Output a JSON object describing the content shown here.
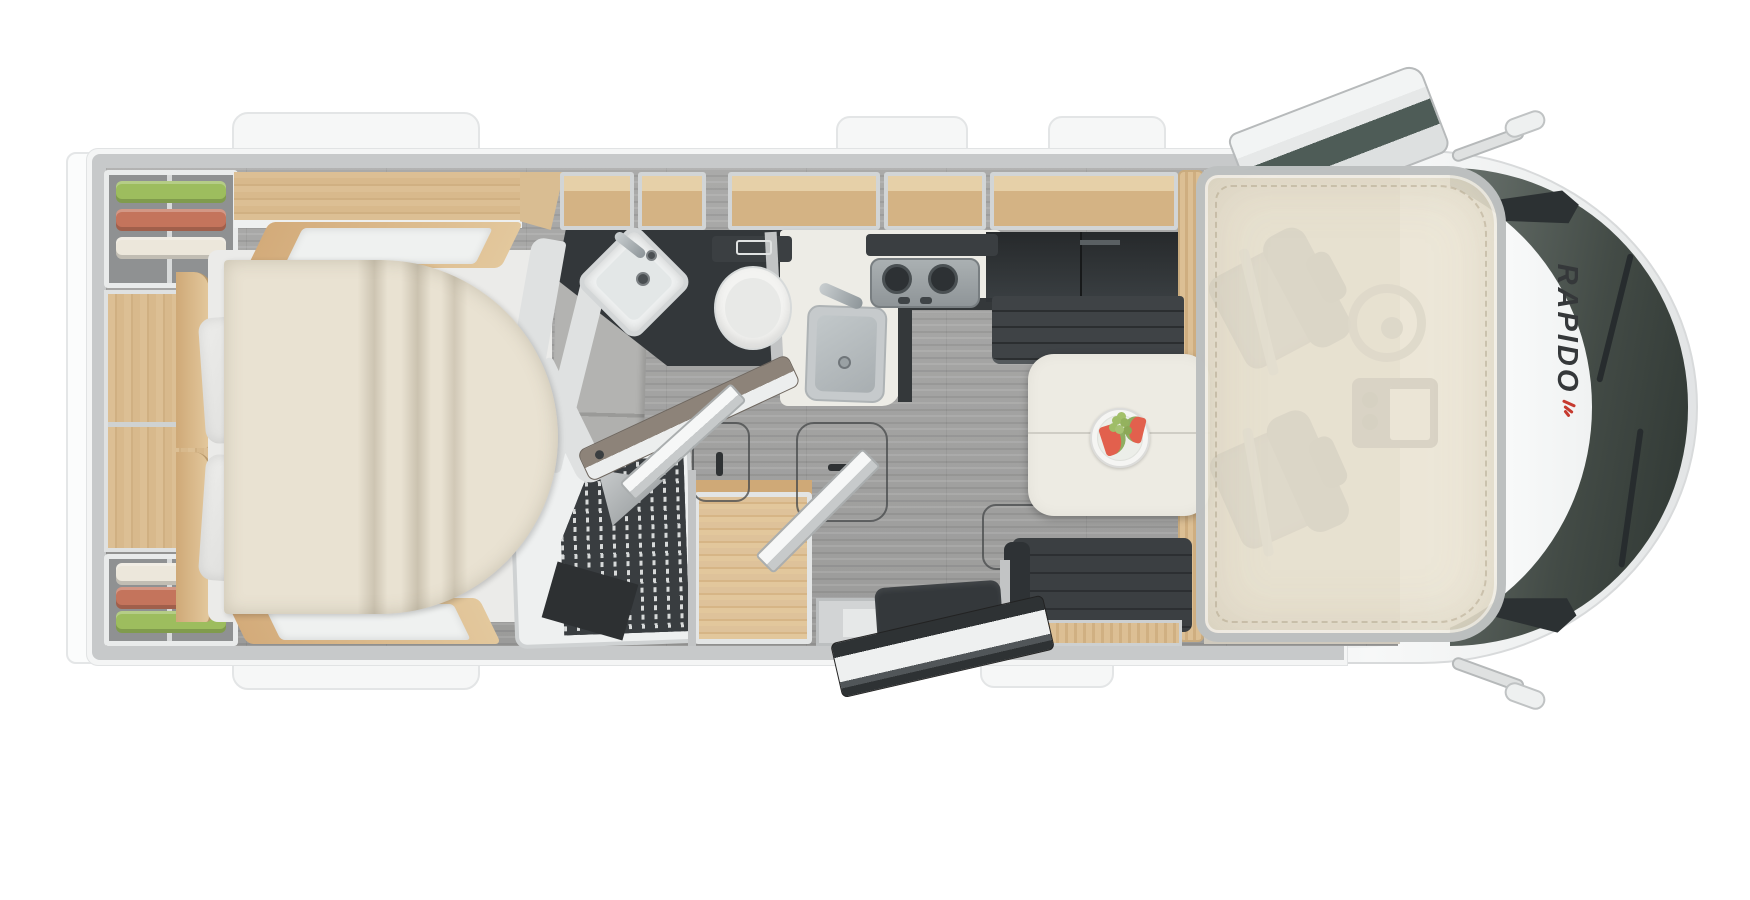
{
  "image": {
    "kind": "motorhome floor plan, top-down 3D render",
    "orientation": "vehicle front (cab) on the right, rear on the left",
    "background": "#ffffff"
  },
  "vehicle": {
    "brand_marking": "RAPIDO",
    "brand_marking_color": "#35383a",
    "brand_accent_color": "#c63a2f",
    "body_color": "#f4f5f5",
    "wall_color": "#c7c9ca",
    "windshield_color": "#434b46"
  },
  "palette": {
    "floor_gray": "#a3a3a2",
    "wood_tan": "#d8b98c",
    "counter_white": "#edece6",
    "upholstery_dark": "#3b3f42",
    "bedding_cream": "#e9e2d2",
    "drop_down_bed_overlay": "rgba(235,228,211,0.88)",
    "clothes_green": "#9dbd5e",
    "clothes_red": "#c4745c",
    "clothes_cream": "#ece7db",
    "watermelon_red": "#e2604d",
    "grape_green": "#9fbd68"
  },
  "areas": {
    "rear_bedroom": [
      "corner-wardrobe-with-clothes-top",
      "corner-wardrobe-with-clothes-bottom",
      "open-shelf-column",
      "island-bed",
      "two-pillows",
      "duvet",
      "bedside-benches",
      "overhead-locker"
    ],
    "bathroom": [
      "corner-washbasin",
      "faucet",
      "toilet",
      "flush-plate",
      "open-bathroom-door",
      "curved-partition-walls"
    ],
    "shower_room": [
      "shower-tray",
      "slatted-grate",
      "corner-shelf",
      "shower-mat",
      "open-shower-door"
    ],
    "wardrobe": [
      "wood-floor-wardrobe",
      "open-wardrobe-door"
    ],
    "kitchen": [
      "l-shaped-counter",
      "sink-with-faucet",
      "two-burner-hob",
      "hob-knobs",
      "overhead-shelves",
      "tall-dark-cabinet"
    ],
    "dinette": [
      "forward-bench-seat",
      "rear-bench-seat",
      "pedestal-table",
      "fruit-plate-watermelon-grapes",
      "magazine-box"
    ],
    "corridor": [
      "floor-hatch-1",
      "floor-hatch-2",
      "floor-hatch-3"
    ],
    "entrance": [
      "entry-step",
      "folding-seat",
      "open-entry-door"
    ],
    "cab": [
      "driver-seat",
      "passenger-seat",
      "steering-wheel",
      "dashboard",
      "drop-down-bed-overlay",
      "windshield-with-wipers",
      "headlights",
      "side-mirrors",
      "open-cab-door",
      "brand-marking"
    ]
  }
}
